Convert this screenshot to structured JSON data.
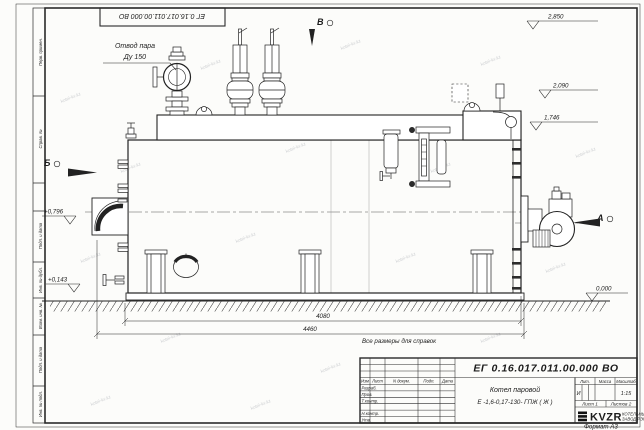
{
  "sheet": {
    "doc_number_stamp": "ЕГ 0.16.017.011.00.000  ВО",
    "format_note": "Формат А3",
    "watermark": "kotel-kv.kz"
  },
  "margin": {
    "perv_primen": "Перв. примен.",
    "sprav_no": "Справ. №",
    "podp_i_data_upper": "Подп. и дата",
    "inv_no_dubl": "Инв. № дубл.",
    "vzam_inv_no": "Взам. инв. №",
    "podp_i_data_lower": "Подп. и дата",
    "inv_no_podl": "Инв. № подл."
  },
  "drawing": {
    "steam_outlet_label": "Отвод пара",
    "steam_outlet_dn": "Ду 150",
    "view_b": "Б",
    "view_v": "В",
    "view_a": "А",
    "elev_2850": "2,850",
    "elev_2090": "2,090",
    "elev_1746": "1,746",
    "elev_zero": "0,000",
    "elev_0796": "+0,796",
    "elev_0143": "+0,143",
    "dim_4080": "4080",
    "dim_4460": "4460",
    "note": "Все размеры для справок"
  },
  "title_block": {
    "doc_number": "ЕГ 0.16.017.011.00.000  ВО",
    "product_name": "Котел паровой",
    "product_code": "Е -1,6-0,17-130- ГПЖ ( Ж )",
    "col_izm": "Изм",
    "col_list": "Лист",
    "col_dokum": "N докум.",
    "col_podp": "Подп.",
    "col_data": "Дата",
    "row_razrab": "Разраб.",
    "row_prov": "Пров.",
    "row_tkontr": "Т.контр.",
    "row_nkontr": "Н.контр.",
    "row_utv": "Утв.",
    "lit_header": "Лит.",
    "mass_header": "Масса",
    "scale_header": "Масштаб",
    "litera": "И",
    "scale": "1:15",
    "sheet_cell": "Лист 1",
    "sheets_cell": "Листов 2",
    "logo_text": "KVZR",
    "logo_sub1": "КОТЕЛЬНЫЙ",
    "logo_sub2": "ЗАВОД РЭП"
  }
}
